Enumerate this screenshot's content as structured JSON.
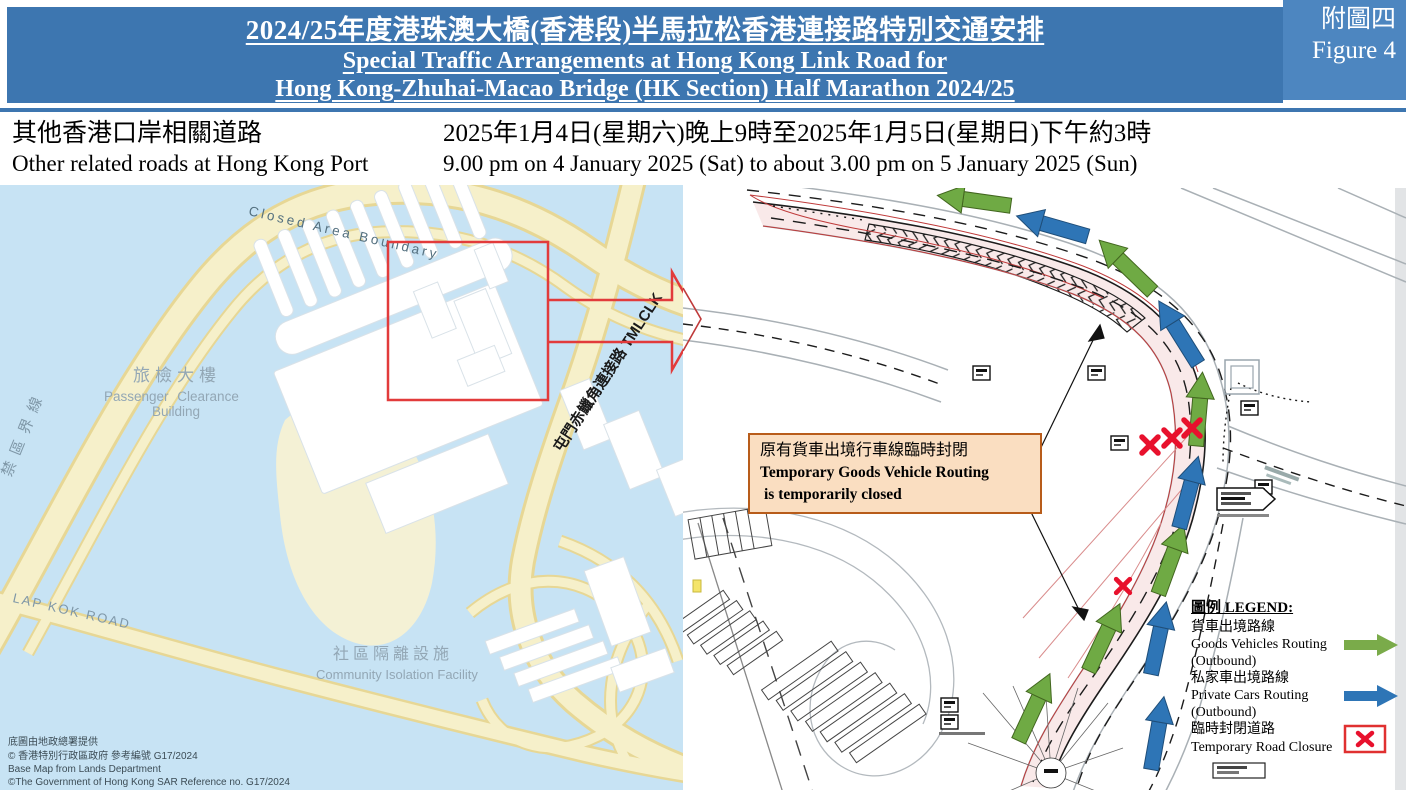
{
  "figure_label": {
    "zh": "附圖四",
    "en": "Figure 4"
  },
  "header": {
    "title_zh": "2024/25年度港珠澳大橋(香港段)半馬拉松香港連接路特別交通安排",
    "title_en1": "Special Traffic Arrangements at Hong Kong Link Road for",
    "title_en2": "Hong Kong-Zhuhai-Macao Bridge (HK Section) Half Marathon 2024/25"
  },
  "subtitle": {
    "left_zh": "其他香港口岸相關道路",
    "left_en": "Other related roads at Hong Kong Port",
    "right_zh": "2025年1月4日(星期六)晚上9時至2025年1月5日(星期日)下午約3時",
    "right_en": "9.00 pm on 4 January 2025 (Sat) to about 3.00 pm on 5 January 2025 (Sun)"
  },
  "left_map": {
    "labels": {
      "closed_area_boundary": "Closed Area Boundary",
      "restricted_zh": "禁區界線",
      "pcb_zh": "旅檢大樓",
      "pcb_en1": "Passenger Clearance",
      "pcb_en2": "Building",
      "tmclk": "屯門赤鱲角連接路 TMLCLK",
      "lap_kok_road": "LAP KOK ROAD",
      "cif_zh": "社區隔離設施",
      "cif_en": "Community Isolation Facility"
    },
    "copyright": [
      "底圖由地政總署提供",
      "© 香港特別行政區政府 參考編號 G17/2024",
      "Base Map from Lands Department",
      "©The Government of Hong Kong SAR Reference no. G17/2024"
    ]
  },
  "callout": {
    "line1_zh": "原有貨車出境行車線臨時封閉",
    "line2_en": "Temporary Goods Vehicle Routing",
    "line3_en": "is temporarily closed"
  },
  "legend": {
    "title": "圖例 LEGEND:",
    "items": [
      {
        "zh": "貨車出境路線",
        "en": "Goods Vehicles Routing",
        "sub": "(Outbound)",
        "symbol": "green-arrow"
      },
      {
        "zh": "私家車出境路線",
        "en": "Private Cars Routing",
        "sub": "(Outbound)",
        "symbol": "blue-arrow"
      },
      {
        "zh": "臨時封閉道路",
        "en": "Temporary Road Closure",
        "sub": "",
        "symbol": "red-x"
      }
    ]
  },
  "colors": {
    "header_blue": "#3d76b0",
    "header_blue_light": "#4d86c0",
    "goods_green": "#6faa44",
    "private_blue": "#2e75b6",
    "closure_red": "#e8112d",
    "closed_lane_pink": "#f9e9e9",
    "red_boundary": "#bf3a3a",
    "water_blue": "#c7e3f4",
    "road_yellow": "#f6f0ca",
    "callout_bg": "#fadec1",
    "callout_border": "#b85c1a"
  }
}
